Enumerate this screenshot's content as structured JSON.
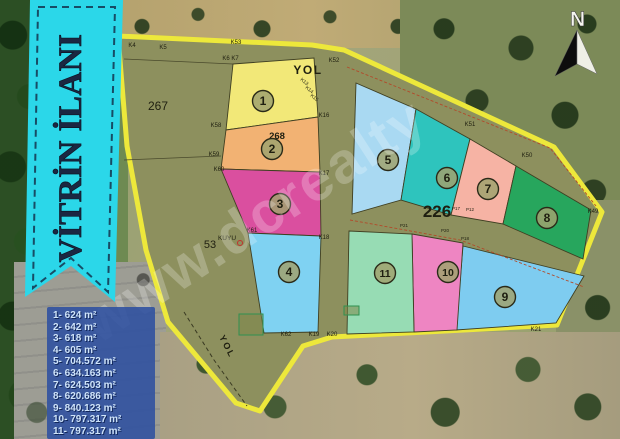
{
  "banner": {
    "title": "VİTRİN İLANI"
  },
  "compass": {
    "north_label": "N"
  },
  "watermark": {
    "text": "www.dcrealty"
  },
  "area_list": {
    "items": [
      "1- 624 m²",
      "2- 642 m²",
      "3- 618 m²",
      "4- 605 m²",
      "5- 704.572 m²",
      "6- 634.163 m²",
      "7- 624.503 m²",
      "8- 620.686 m²",
      "9- 840.123 m²",
      "10- 797.317 m²",
      "11- 797.317 m²"
    ]
  },
  "map": {
    "parcel_numbers": [
      "1",
      "2",
      "3",
      "4",
      "5",
      "6",
      "7",
      "8",
      "9",
      "10",
      "11"
    ],
    "region_labels": {
      "block_267": "267",
      "block_53": "53",
      "block_268": "268",
      "road_226": "226"
    },
    "road_top_label": "YOL",
    "road_bottom_label": "YOL",
    "well_label": "KUYU",
    "point_labels": [
      "K4",
      "K5",
      "K53",
      "K6",
      "K7",
      "K52",
      "K16",
      "K17",
      "K18",
      "K58",
      "K59",
      "K60",
      "K61",
      "K62",
      "K19",
      "K20",
      "K21",
      "K51",
      "K50",
      "K49",
      "K13",
      "K14",
      "K15",
      "P17",
      "P12",
      "P21",
      "P20",
      "P18"
    ]
  },
  "colors": {
    "ribbon": "#2BD7E9",
    "ribbon_text": "#1B2742",
    "map_base": "#8D905E",
    "map_border": "#EDE83B",
    "area_box_bg": "#2D50A0",
    "area_box_text": "#CFE4FA",
    "parcels": {
      "1": "#F2E878",
      "2": "#F2B273",
      "3": "#DA4F9F",
      "4": "#7FD2F2",
      "5": "#A9D9F2",
      "6": "#2EC4BD",
      "7": "#F6B3A4",
      "8": "#27A65D",
      "9": "#7ECCF0",
      "10": "#EE85C2",
      "11": "#97DCB4"
    }
  }
}
